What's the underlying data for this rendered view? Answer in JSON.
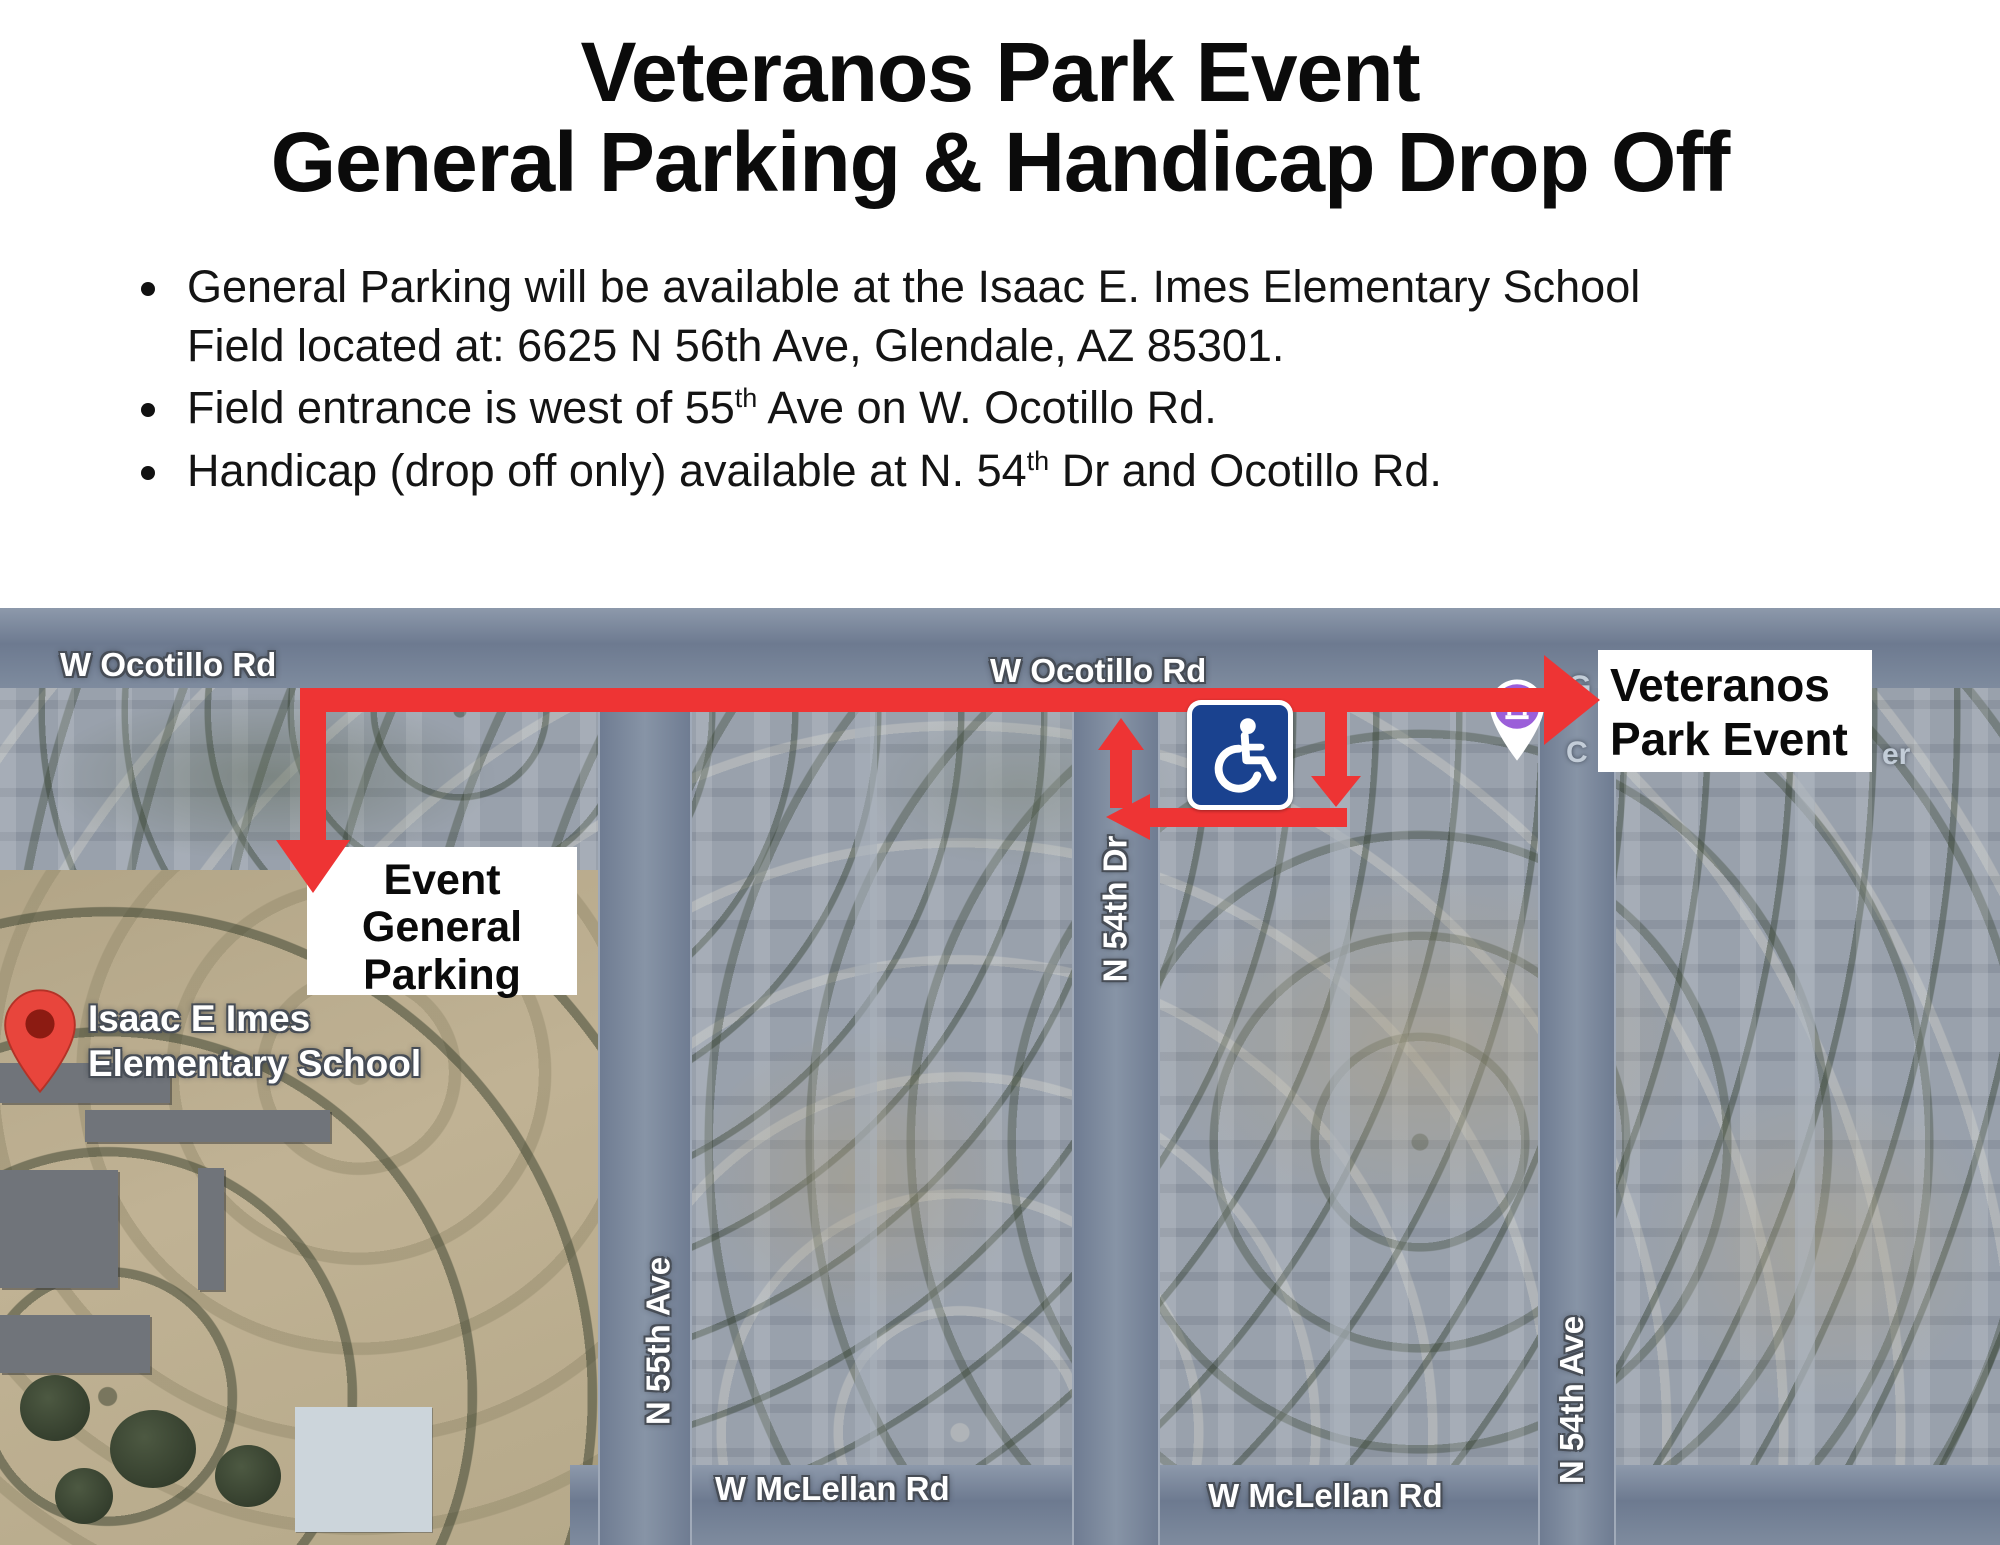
{
  "title": {
    "line1": "Veteranos Park Event",
    "line2": "General Parking & Handicap Drop Off"
  },
  "bullets": {
    "b1_line1": "General Parking will be available at the Isaac E. Imes Elementary School",
    "b1_line2": "Field located at: 6625 N 56th Ave, Glendale, AZ 85301.",
    "b2_pre": "Field entrance is west of 55",
    "b2_sup": "th",
    "b2_post": " Ave on W. Ocotillo Rd.",
    "b3_pre": "Handicap (drop off only) available at N. 54",
    "b3_sup": "th",
    "b3_post": " Dr and Ocotillo Rd."
  },
  "map": {
    "road_labels": {
      "ocotillo_left": "W Ocotillo Rd",
      "ocotillo_center": "W Ocotillo Rd",
      "mclellan_left": "W McLellan Rd",
      "mclellan_right": "W McLellan Rd",
      "ave55": "N 55th Ave",
      "dr54": "N 54th Dr",
      "ave54": "N 54th Ave"
    },
    "poi": {
      "school_line1": "Isaac E Imes",
      "school_line2": "Elementary School"
    },
    "fragments": {
      "g": "G",
      "c": "C",
      "er": "er"
    },
    "callouts": {
      "event": {
        "line1": "Veteranos",
        "line2": "Park Event"
      },
      "parking": {
        "line1": "Event",
        "line2": "General",
        "line3": "Parking"
      }
    },
    "icons": {
      "handicap": "wheelchair-icon",
      "school_pin": "location-pin-icon",
      "poi_pin": "museum-pin-icon"
    }
  },
  "colors": {
    "route-red": "#ee3434",
    "handicap-blue": "#1a428f",
    "poi-purple": "#9b5fd9",
    "pin-red": "#e8453c",
    "pin-red-dark": "#8c1b12",
    "road": "#76839b",
    "map-base": "#99a1ac",
    "school-tan": "#b7aa8c",
    "court": "#ccd5db",
    "label-halo": "#474d56",
    "building-gray": "#70747a"
  }
}
